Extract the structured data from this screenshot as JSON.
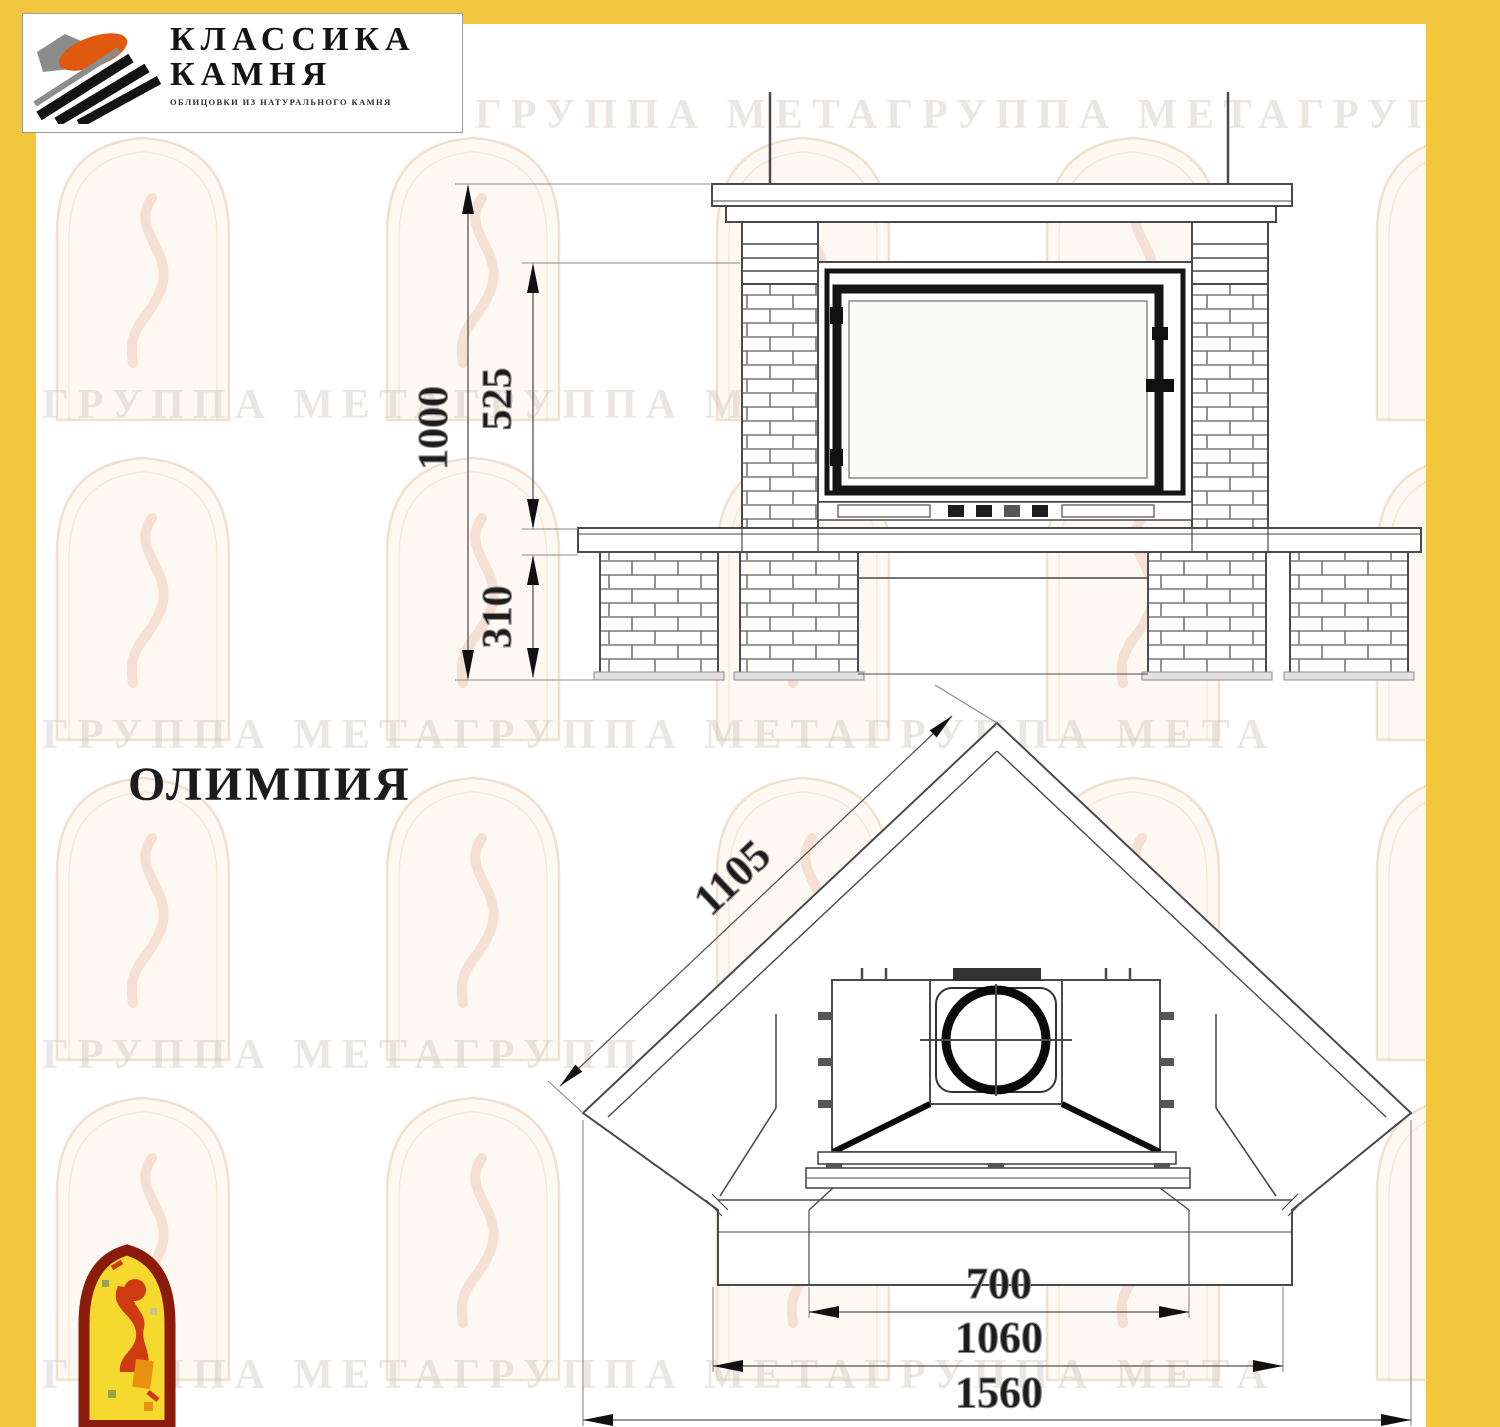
{
  "brand": {
    "name_line1": "КЛАССИКА",
    "name_line2": "КАМНЯ",
    "tagline": "ОБЛИЦОВКИ ИЗ НАТУРАЛЬНОГО КАМНЯ"
  },
  "title": "ОЛИМПИЯ",
  "watermark_text": "ГРУППА МЕТАГРУППА МЕТАГРУППА МЕТА",
  "colors": {
    "frame_yellow": "#F2C63F",
    "paper_white": "#FFFFFF",
    "drawing_line": "#4a4a4a",
    "heavy_line": "#141414",
    "logo_orange": "#E0590F",
    "emblem_border_red": "#8B1C0C",
    "emblem_fill_yellow": "#F6D92E",
    "emblem_figure_red": "#CE3A12"
  },
  "front_view": {
    "dims": {
      "total_height": "1000",
      "opening_height": "525",
      "base_height": "310"
    }
  },
  "plan_view": {
    "dims": {
      "side_depth": "1105",
      "opening_width": "700",
      "front_width": "1060",
      "total_width": "1560"
    }
  }
}
